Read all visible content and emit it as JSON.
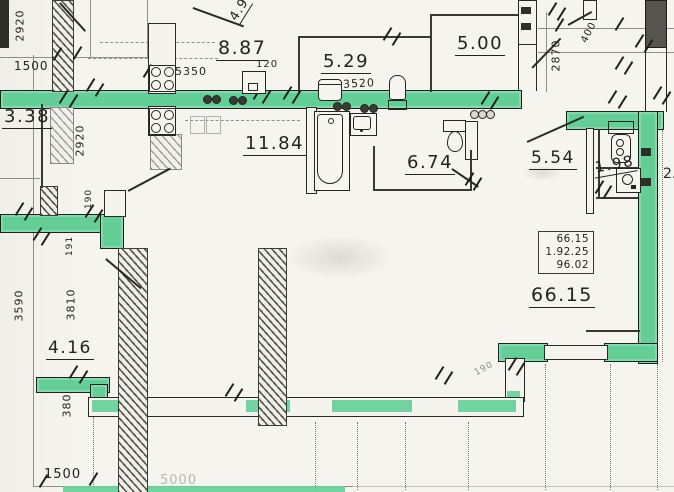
{
  "plan": {
    "type": "apartment-floor-plan-scan",
    "room_areas": {
      "top_left_partial": "4.9",
      "kitchen_top": "8.87",
      "bath_top": "5.29",
      "hall_top_right": "5.00",
      "left_small": "3.38",
      "kitchen_main": "11.84",
      "bathroom_main": "6.74",
      "hall_right": "5.54",
      "wc_right": "1.98",
      "corridor_bottom_left": "4.16",
      "right_edge_partial": "2."
    },
    "area_table": {
      "row1": "66.15",
      "row2": "1.92.25",
      "row3": "96.02",
      "total": "66.15"
    },
    "dimensions": {
      "top_left_height": "2920",
      "top_left_width": "1500",
      "stove_code": "5350",
      "small_offset": "120",
      "bath_width": "3520",
      "right_top_height": "2870",
      "right_top_offset": "400",
      "left_mid_height": "2920",
      "bottom_left_height": "3590",
      "corridor_height": "3810",
      "wall_thickness_a": "190",
      "wall_thickness_b": "191",
      "bottom_offset": "380",
      "bottom_width": "1500",
      "bottom_span": "5000",
      "step_thickness": "190"
    },
    "fixtures": [
      "gas-stove",
      "gas-stove",
      "kitchen-sink",
      "washing-machine",
      "water-heater",
      "bathtub",
      "washbasin",
      "toilet",
      "toilet",
      "washbasin"
    ],
    "colors": {
      "wall_highlight": "#63cf96",
      "ink": "#26261f",
      "paper": "#f5f4ee"
    }
  }
}
